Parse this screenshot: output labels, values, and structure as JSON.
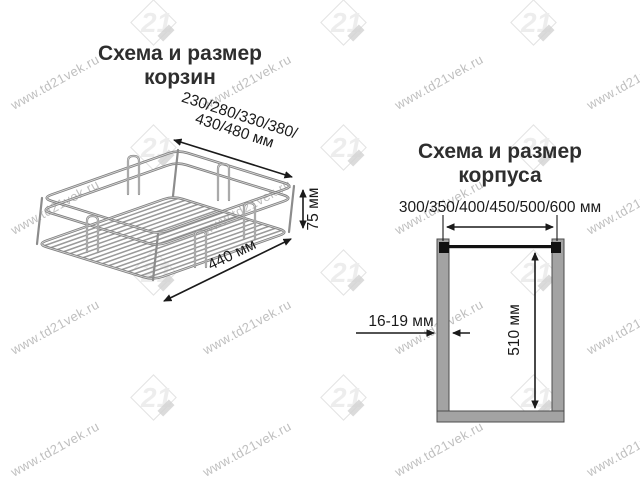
{
  "watermarks": {
    "url": "www.td21vek.ru",
    "logo": "21"
  },
  "basket": {
    "title": [
      "Схема и размер",
      "корзин"
    ],
    "width_label": [
      "230/280/330/380/",
      "430/480 мм"
    ],
    "height_label": "75 мм",
    "depth_label": "440 мм"
  },
  "cabinet": {
    "title": [
      "Схема и размер",
      "корпуса"
    ],
    "width_label": "300/350/400/450/500/600 мм",
    "thickness_label": "16-19 мм",
    "height_label": "510 мм"
  },
  "colors": {
    "dimension": "#1a1a1a",
    "wire": "#8c8c8c",
    "wire_highlight": "#d6d6d6",
    "panel_fill": "#a3a3a3",
    "panel_stroke": "#4d4d4d",
    "top_rail": "#111111",
    "watermark_text": "#bfbfbf",
    "watermark_logo": "#e3e3e3",
    "title_text": "#2e2e2e"
  }
}
